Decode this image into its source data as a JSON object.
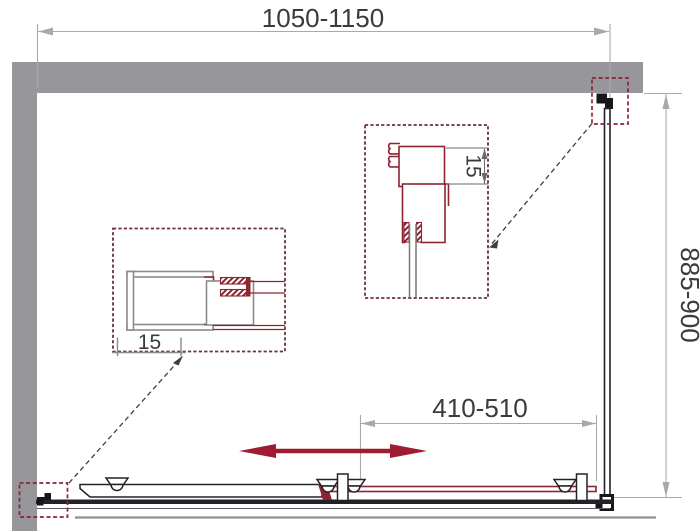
{
  "diagram": {
    "dimensions": {
      "width_range": "1050-1150",
      "depth_range": "885-900",
      "door_travel_range": "410-510",
      "left_detail_offset": "15",
      "right_detail_offset": "15"
    },
    "colors": {
      "wall_gray": "#97969b",
      "dimension_gray": "#a9a9ad",
      "text_dark": "#3b3b3d",
      "profile_red": "#8d2533",
      "arrow_red": "#9e1b32",
      "line_dark": "#232327"
    }
  }
}
